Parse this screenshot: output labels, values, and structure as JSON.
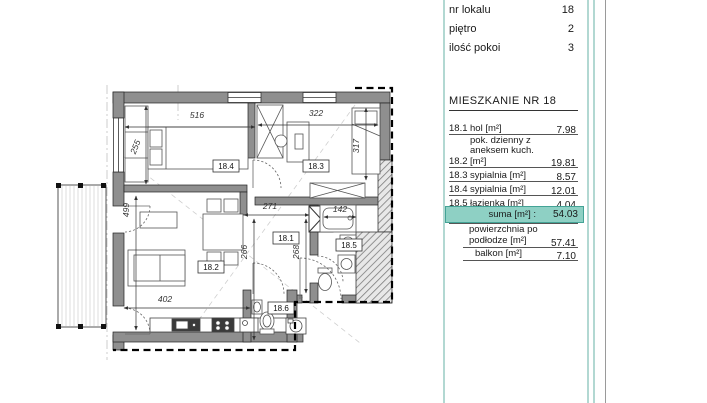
{
  "panel": {
    "info_rows": [
      {
        "label": "nr lokalu",
        "value": "18"
      },
      {
        "label": "piętro",
        "value": "2"
      },
      {
        "label": "ilość pokoi",
        "value": "3"
      }
    ],
    "heading": "MIESZKANIE NR 18",
    "room_rows": [
      {
        "no": "18.1",
        "name": "hol [m²]",
        "area": "7.98"
      },
      {
        "no": "18.2",
        "name_line1": "pok. dzienny z",
        "name_line2": "aneksem kuch. [m²]",
        "area": "19.81"
      },
      {
        "no": "18.3",
        "name": "sypialnia [m²]",
        "area": "8.57"
      },
      {
        "no": "18.4",
        "name": "sypialnia [m²]",
        "area": "12.01"
      },
      {
        "no": "18.5",
        "name": "łazienka [m²]",
        "area": "4.04"
      },
      {
        "no": "18.6",
        "name": "toaleta [m²]",
        "area": "1.62"
      }
    ],
    "sum_row": {
      "label": "suma [m²] :",
      "value": "54.03"
    },
    "extra_rows": [
      {
        "label_line1": "powierzchnia po",
        "label_line2": "podłodze [m²]",
        "value": "57.41"
      },
      {
        "label_line1": "balkon [m²]",
        "value": "7.10"
      }
    ],
    "colors": {
      "sum_highlight_bg": "#8ed0c4",
      "sum_highlight_border": "#44a396",
      "teal_divider": "#b2d8d2",
      "gray_divider": "#9a9a9a"
    }
  },
  "floor_plan": {
    "room_labels": {
      "hol": "18.1",
      "living": "18.2",
      "bedroom_small": "18.3",
      "bedroom_large": "18.4",
      "bathroom": "18.5",
      "toilet": "18.6"
    },
    "dimensions": {
      "d516": "516",
      "d322": "322",
      "d255": "255",
      "d317": "317",
      "d271": "271",
      "d142": "142",
      "d266": "266",
      "d268": "268",
      "d499": "499",
      "d402": "402"
    }
  }
}
